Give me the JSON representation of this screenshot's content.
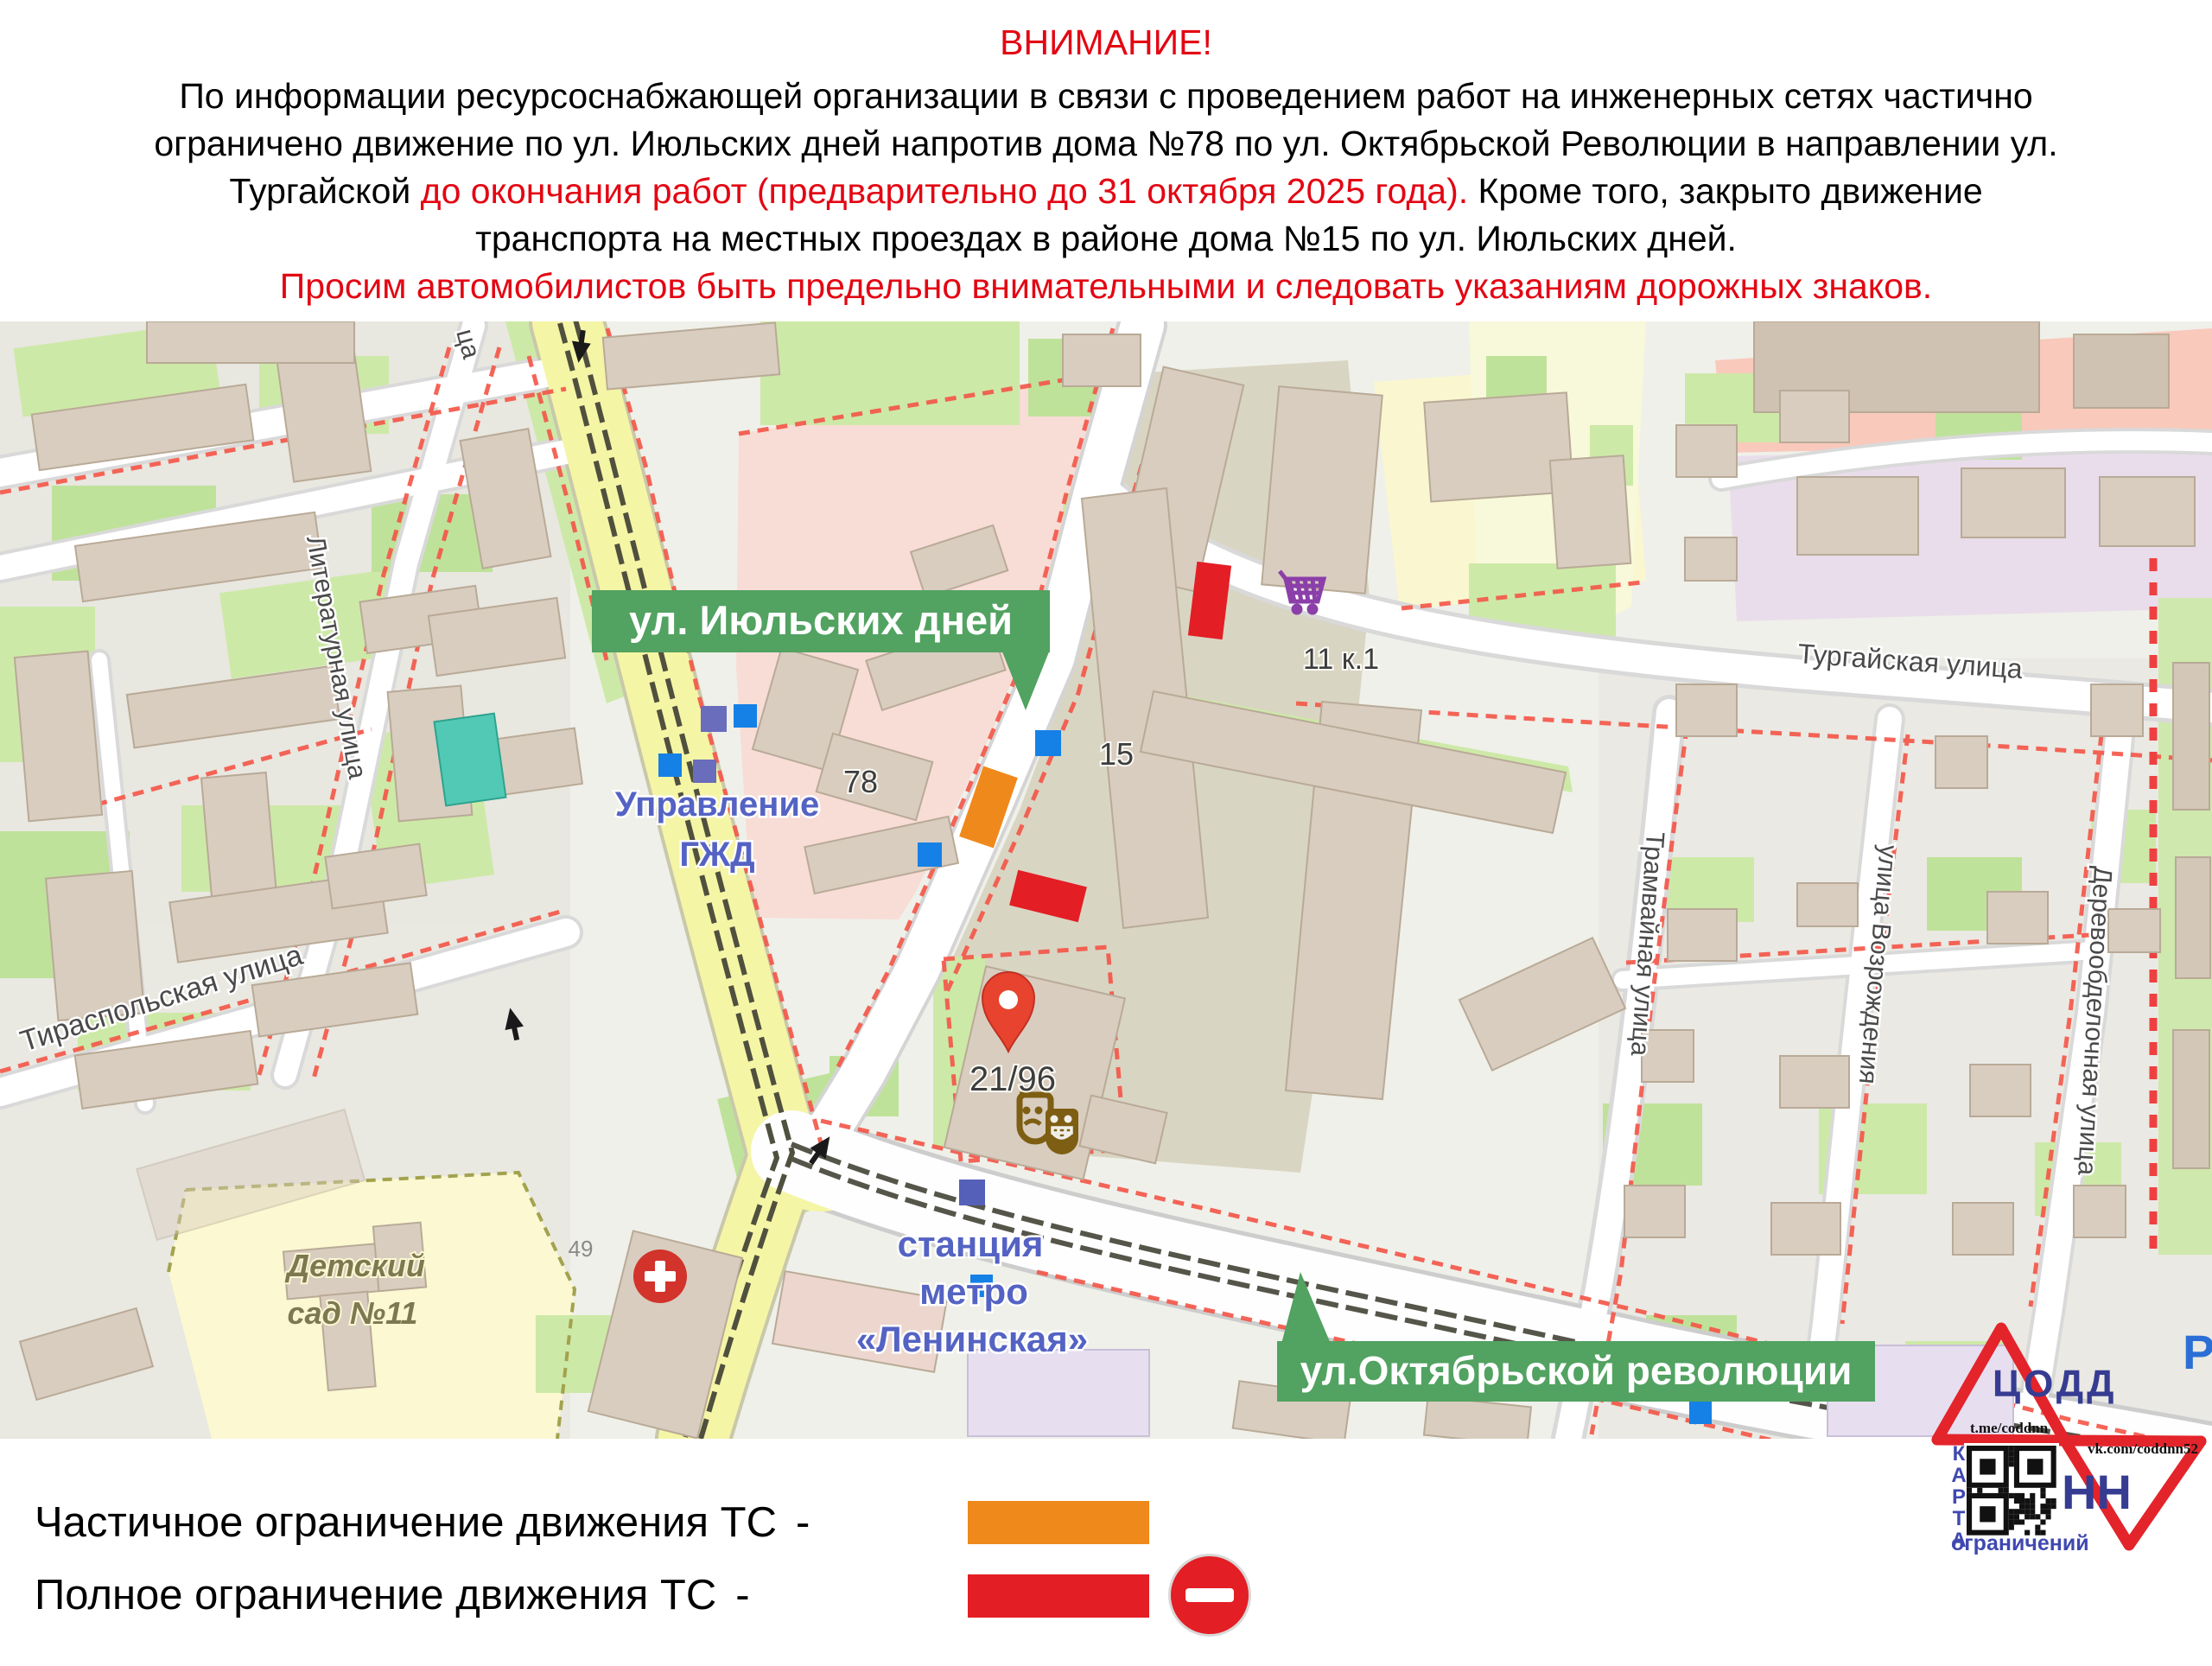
{
  "notice": {
    "title": "ВНИМАНИЕ!",
    "line1": "По информации ресурсоснабжающей организации в связи с проведением работ на инженерных сетях частично",
    "line2": "ограничено движение по ул. Июльских дней напротив дома №78 по ул. Октябрьской Революции в направлении ул.",
    "line3_black1": "Тургайской ",
    "line3_red": "до окончания работ (предварительно до 31 октября 2025 года).",
    "line3_black2": " Кроме того, закрыто движение",
    "line4": "транспорта на местных проездах в районе дома №15 по ул. Июльских дней.",
    "line5": "Просим автомобилистов быть предельно внимательными и следовать указаниям дорожных знаков."
  },
  "map": {
    "badge_july": "ул. Июльских дней",
    "badge_october": "ул.Октябрьской революции",
    "street_turgayskaya": "Тургайская улица",
    "street_tramvaynaya": "Трамвайная улица",
    "street_vozrozhdeniya": "улица Возрождения",
    "street_derevoobdelochnaya": "Деревообделочная улица",
    "street_literaturnaya": "Литературная улица",
    "street_tiraspolskaya": "Тираспольская улица",
    "street_fragment": "ца",
    "poi_upravlenie_line1": "Управление",
    "poi_upravlenie_line2": "ГЖД",
    "poi_metro_line1": "станция",
    "poi_metro_line2": "метро",
    "poi_metro_line3": "«Ленинская»",
    "poi_kindergarten_line1": "Детский",
    "poi_kindergarten_line2": "сад №11",
    "house_78": "78",
    "house_15": "15",
    "house_11k1": "11 к.1",
    "house_2196": "21/96",
    "house_49": "49",
    "parking_letter": "P"
  },
  "legend": {
    "partial_label": "Частичное ограничение движения ТС",
    "full_label": "Полное ограничение движения ТС",
    "dash": "-"
  },
  "logo": {
    "org": "ЦОДД",
    "city": "НН",
    "telegram": "t.me/coddnn",
    "vk": "vk.com/coddnn52",
    "karta": "КАРТА",
    "ogranicheniy": "ограничений"
  },
  "colors": {
    "alert_red": "#e30613",
    "partial_orange": "#f0891c",
    "full_red": "#e31e24",
    "badge_green": "#52a261",
    "logo_blue": "#363c91",
    "logo_red": "#e3242b",
    "poi_blue": "#5463c3"
  }
}
